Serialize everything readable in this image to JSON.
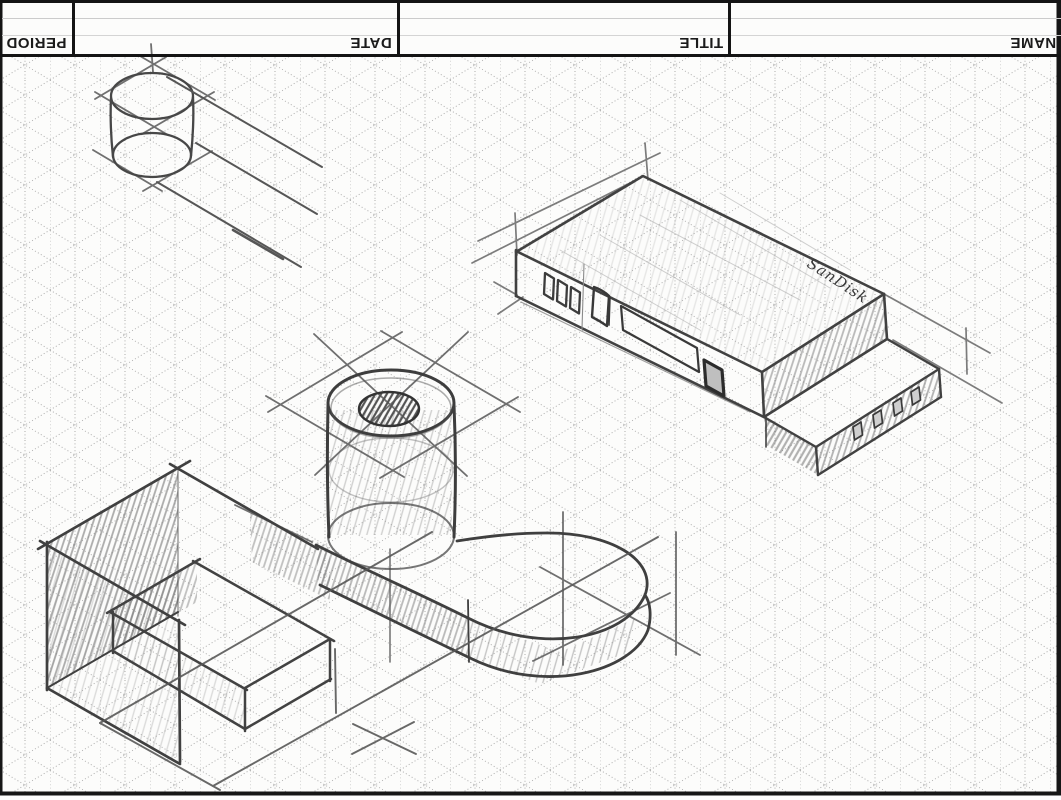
{
  "title_block": {
    "cells": [
      {
        "label": "PERIOD"
      },
      {
        "label": "DATE"
      },
      {
        "label": "TITLE"
      },
      {
        "label": "NAME"
      }
    ],
    "text_rotation_deg": 180
  },
  "sketch": {
    "logo_text": "SanDisk",
    "objects": [
      "cylinder-study",
      "usb-flash-drive",
      "cylinder-on-rounded-base",
      "stepped-block"
    ]
  },
  "colors": {
    "paper": "#fcfcfb",
    "grid_line": "#9c9c9c",
    "pencil_dark": "#3f3f3f",
    "pencil_medium": "#5a5a5a",
    "pencil_light": "#8e8e8e",
    "border_black": "#141414"
  }
}
